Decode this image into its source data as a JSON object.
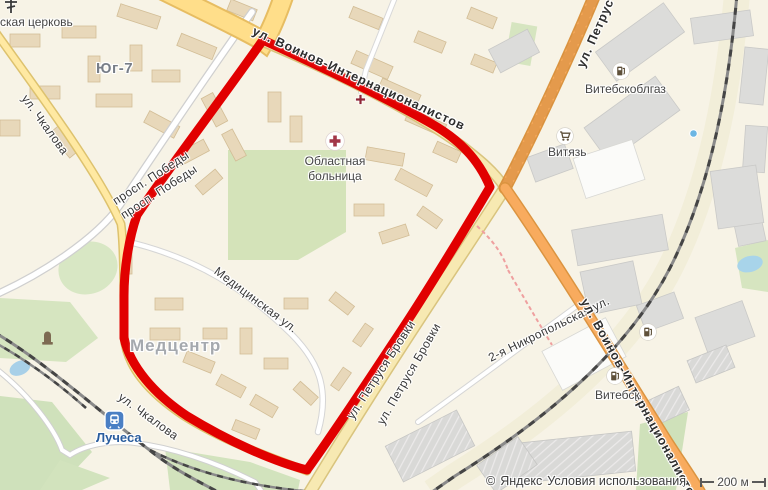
{
  "map": {
    "attribution": {
      "copyright": "©",
      "brand": "Яндекс",
      "terms": "Условия использования"
    },
    "scale_label": "200 м",
    "districts": [
      {
        "id": "yug7",
        "text": "Юг-7"
      },
      {
        "id": "medcentr",
        "text": "Медцентр"
      }
    ],
    "streets": [
      {
        "id": "voinov-top",
        "text": "ул. Воинов-Интернационалистов"
      },
      {
        "id": "petrusya-top",
        "text": "ул. Петрус"
      },
      {
        "id": "prosp-pobedy-1",
        "text": "просп. Победы"
      },
      {
        "id": "prosp-pobedy-2",
        "text": "просп. Победы"
      },
      {
        "id": "chkalova-top",
        "text": "ул. Чкалова"
      },
      {
        "id": "meditsinskaya",
        "text": "Медицинская ул."
      },
      {
        "id": "chkalova-bottom",
        "text": "ул. Чкалова"
      },
      {
        "id": "petrusya-brovki-1",
        "text": "ул. Петруся Бровки"
      },
      {
        "id": "petrusya-brovki-2",
        "text": "ул. Петруся Бровки"
      },
      {
        "id": "nikropolskaya",
        "text": "2-я Никропольская ул."
      },
      {
        "id": "voinov-right",
        "text": "ул. Воинов-Интернационалистов"
      }
    ],
    "pois": [
      {
        "id": "church",
        "label": "ская церковь",
        "icon": "church-cross-icon"
      },
      {
        "id": "vitebskoblgaz",
        "label": "Витебскоблгаз",
        "icon": "gas-station-icon"
      },
      {
        "id": "vityaz",
        "label": "Витязь",
        "icon": "shopping-cart-icon"
      },
      {
        "id": "hospital",
        "label_line1": "Областная",
        "label_line2": "больница",
        "icon": "hospital-cross-icon"
      },
      {
        "id": "vitebsk-gas",
        "label": "Витебск",
        "icon": "gas-station-icon"
      },
      {
        "id": "gas-secondary",
        "icon": "gas-station-icon"
      },
      {
        "id": "luchesa-station",
        "label": "Лучеса",
        "icon": "train-station-icon"
      },
      {
        "id": "monument",
        "icon": "monument-icon"
      },
      {
        "id": "small-cross",
        "icon": "red-cross-icon"
      },
      {
        "id": "blue-dot",
        "icon": "poi-dot-icon"
      }
    ],
    "colors": {
      "selection_outline": "#e10000",
      "land": "#f7f3e6",
      "green_area": "#d4e3b9",
      "water": "#a8d0e8",
      "road_orange": "#f8ab5e",
      "road_yellow": "#ffde8a",
      "building_residential": "#e8d8ba",
      "building_industrial": "#dcdcda"
    }
  }
}
